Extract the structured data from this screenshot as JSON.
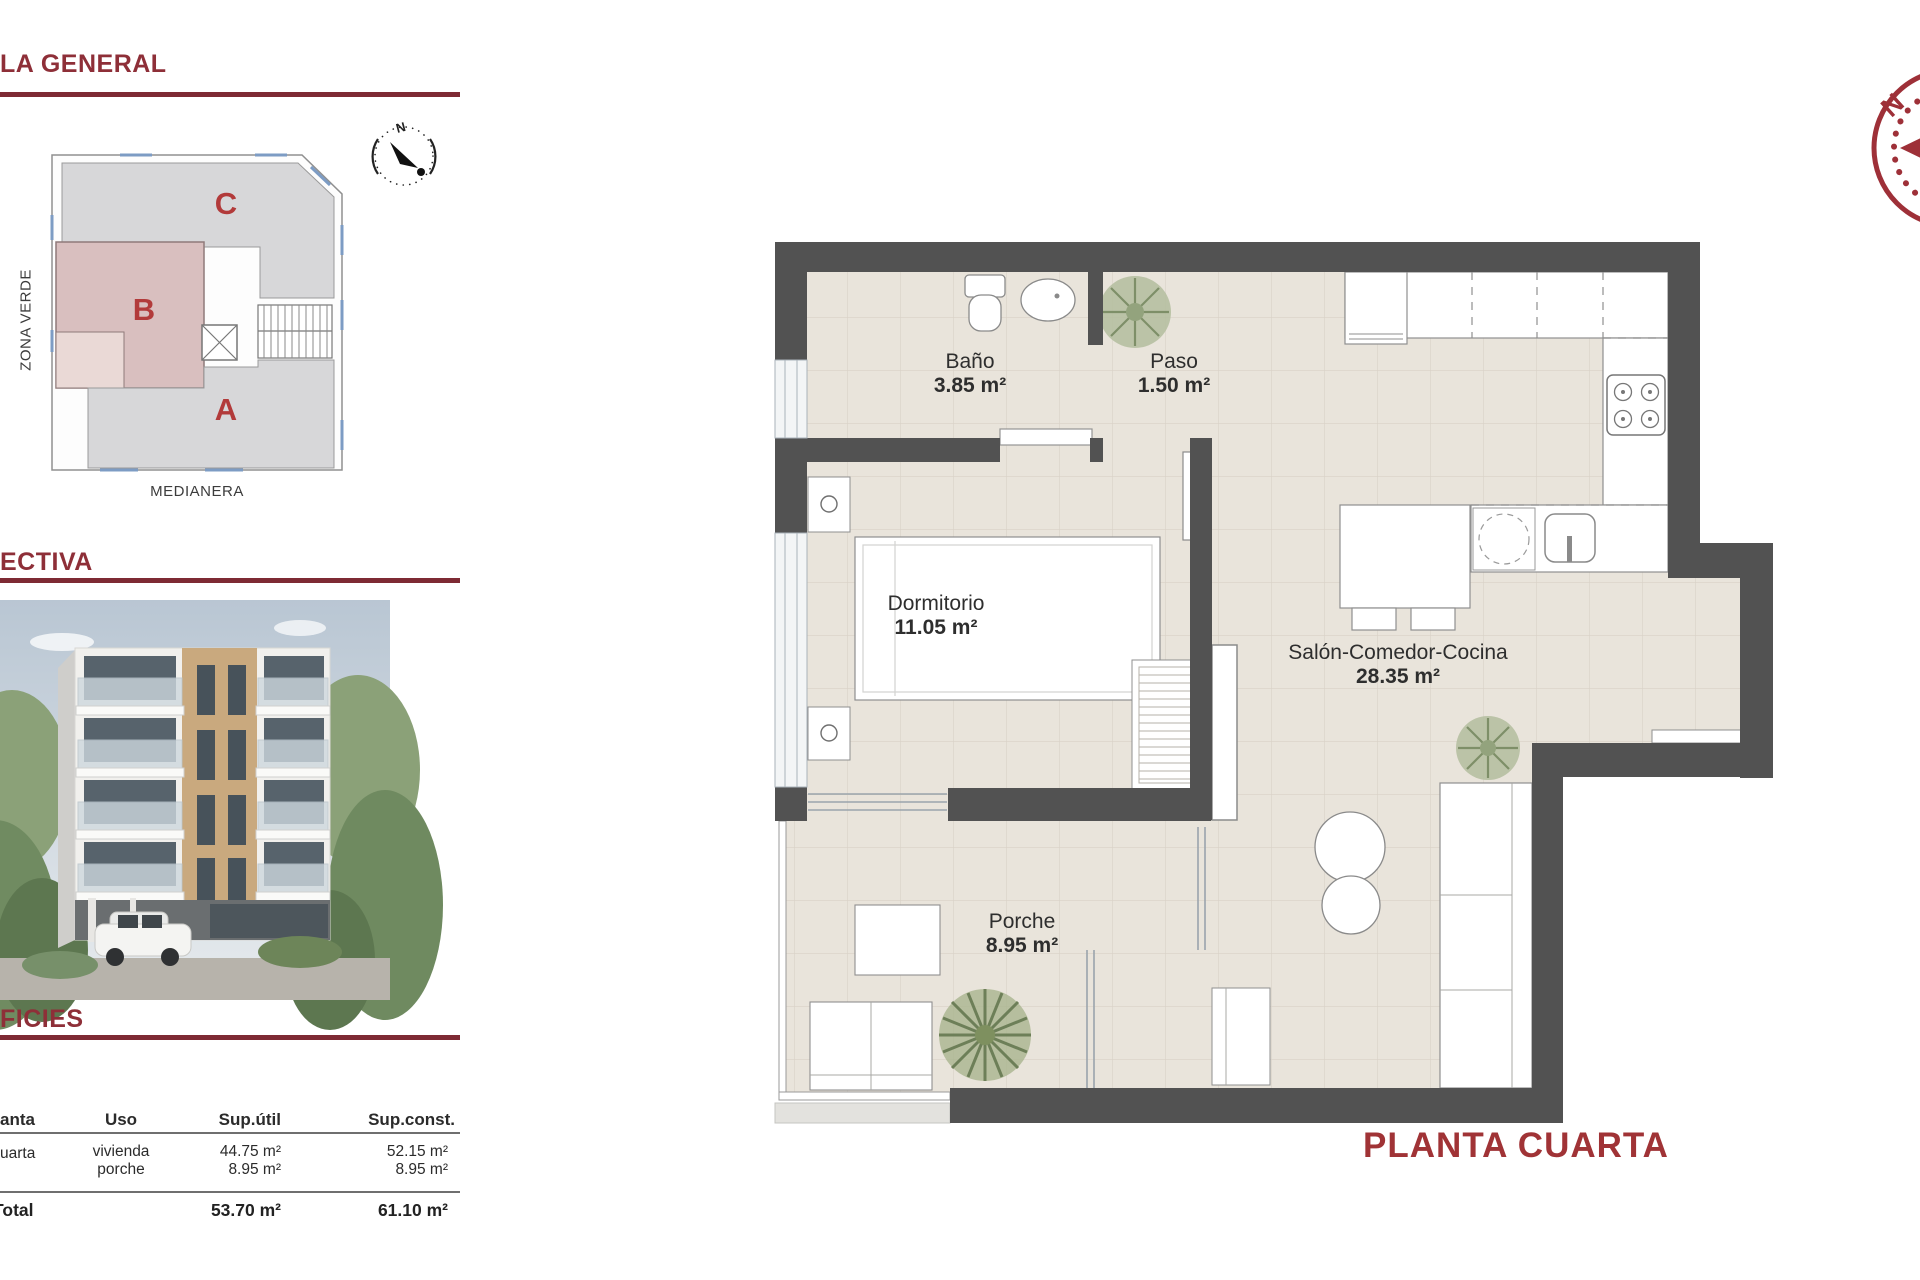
{
  "sections": {
    "general": {
      "title": "LA GENERAL"
    },
    "perspectiva": {
      "title": "ECTIVA"
    },
    "superficies": {
      "title": "FICIES"
    }
  },
  "site_plan": {
    "zone_a": "A",
    "zone_b": "B",
    "zone_c": "C",
    "left_label": "ZONA VERDE",
    "bottom_label": "MEDIANERA",
    "compass_n": "N"
  },
  "table": {
    "col_planta": "anta",
    "col_uso": "Uso",
    "col_sup_util": "Sup.útil",
    "col_sup_const": "Sup.const.",
    "row": {
      "planta": "uarta",
      "uso1": "vivienda",
      "uso2": "porche",
      "util1": "44.75 m²",
      "util2": "8.95 m²",
      "const1": "52.15 m²",
      "const2": "8.95 m²"
    },
    "total": {
      "label": "Total",
      "util": "53.70 m²",
      "const": "61.10 m²"
    }
  },
  "plan": {
    "rooms": [
      {
        "name": "Baño",
        "area": "3.85 m²"
      },
      {
        "name": "Paso",
        "area": "1.50 m²"
      },
      {
        "name": "Dormitorio",
        "area": "11.05 m²"
      },
      {
        "name": "Salón-Comedor-Cocina",
        "area": "28.35 m²"
      },
      {
        "name": "Porche",
        "area": "8.95 m²"
      }
    ],
    "title": "PLANTA CUARTA",
    "compass_n": "N"
  },
  "colors": {
    "accent_red": "#8e2f38",
    "plan_title_red": "#a03336",
    "wall_gray": "#525252",
    "zone_pink": "#d9bfbf",
    "zone_gray": "#d7d7d9",
    "tile": "#e9e4db"
  }
}
